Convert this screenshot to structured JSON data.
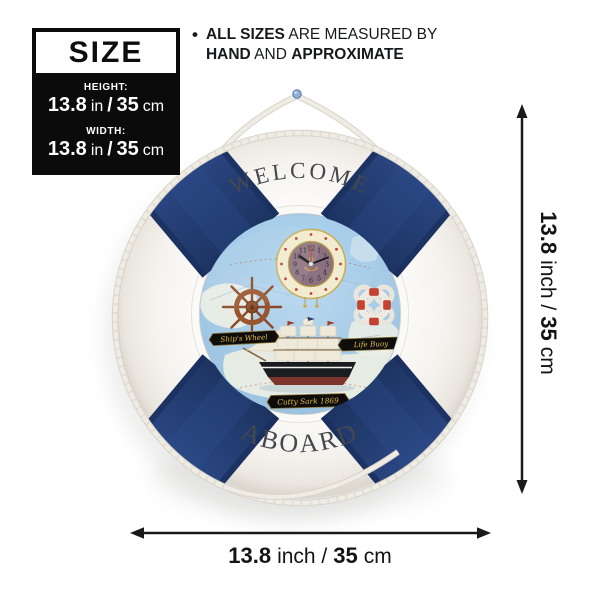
{
  "size_panel": {
    "title": "SIZE",
    "rows": [
      {
        "label": "HEIGHT:",
        "num_in": "13.8",
        "unit_in": "in",
        "slash": "/",
        "num_cm": "35",
        "unit_cm": "cm"
      },
      {
        "label": "WIDTH:",
        "num_in": "13.8",
        "unit_in": "in",
        "slash": "/",
        "num_cm": "35",
        "unit_cm": "cm"
      }
    ]
  },
  "note": {
    "bullet": "•",
    "line1_bold": "ALL SIZES",
    "line1_rest": " ARE MEASURED BY",
    "line2_bold1": "HAND",
    "line2_mid": " AND ",
    "line2_bold2": "APPROXIMATE"
  },
  "product": {
    "top_text": "WELCOME",
    "bottom_text": "ABOARD",
    "plaque_wheel": "Ship's Wheel",
    "plaque_buoy": "Life Buoy",
    "plaque_ship": "Cutty Sark 1869",
    "anchor_symbol": "⚓",
    "colors": {
      "band_navy": "#24407a",
      "ring_white": "#f7f5f2",
      "rope": "#edeae3",
      "map_sea": "#aed0e9",
      "clock_face": "#f1ebcf",
      "clock_disc": "#8c7280",
      "plaque_gold": "#e3bd4e",
      "hull_black": "#1b1c20",
      "keel_red": "#7c352a",
      "wheel_brown": "#8a4a28",
      "dim_arrow": "#1a1a1a"
    }
  },
  "clock": {
    "numerals": [
      "12",
      "1",
      "2",
      "3",
      "4",
      "5",
      "6",
      "7",
      "8",
      "9",
      "10",
      "11"
    ]
  },
  "dimensions": {
    "vertical": {
      "num1": "13.8",
      "unit1": "inch /",
      "num2": "35",
      "unit2": "cm"
    },
    "horizontal": {
      "num1": "13.8",
      "unit1": "inch /",
      "num2": "35",
      "unit2": "cm"
    }
  }
}
